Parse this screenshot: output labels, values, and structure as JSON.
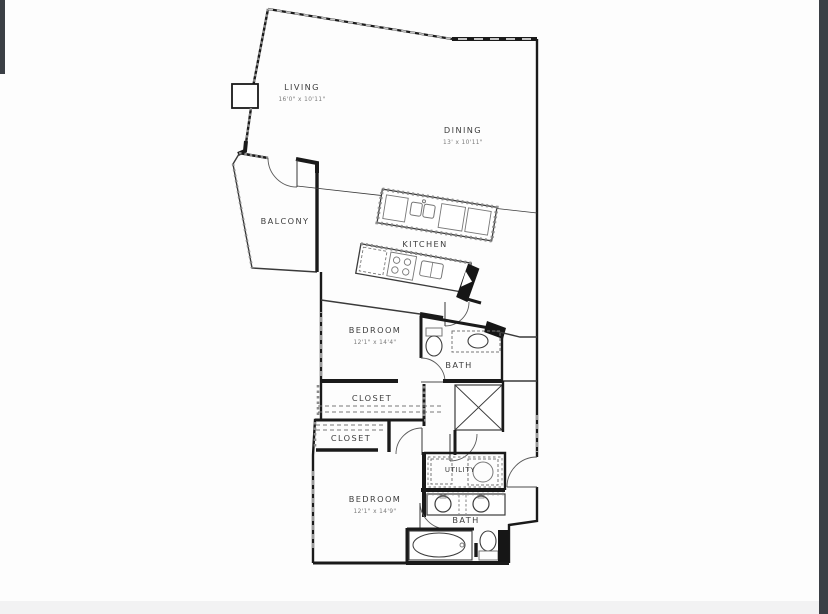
{
  "image": {
    "type": "floor-plan",
    "background": "#fdfdfd",
    "edge_bar_color": "#3b3f45",
    "bottom_strip_color": "#f2f2f3",
    "wall_color": "#1a1a1a",
    "label_color": "#3d3d3d",
    "dim_color": "#7a7a7a"
  },
  "rooms": {
    "living": {
      "label": "LIVING",
      "dims": "16'0\" x 10'11\""
    },
    "dining": {
      "label": "DINING",
      "dims": "13' x 10'11\""
    },
    "balcony": {
      "label": "BALCONY"
    },
    "kitchen": {
      "label": "KITCHEN"
    },
    "bedroom1": {
      "label": "BEDROOM",
      "dims": "12'1\" x 14'4\""
    },
    "bath1": {
      "label": "BATH"
    },
    "closet1": {
      "label": "CLOSET"
    },
    "closet2": {
      "label": "CLOSET"
    },
    "utility": {
      "label": "UTILITY"
    },
    "bedroom2": {
      "label": "BEDROOM",
      "dims": "12'1\" x 14'9\""
    },
    "bath2": {
      "label": "BATH"
    }
  }
}
